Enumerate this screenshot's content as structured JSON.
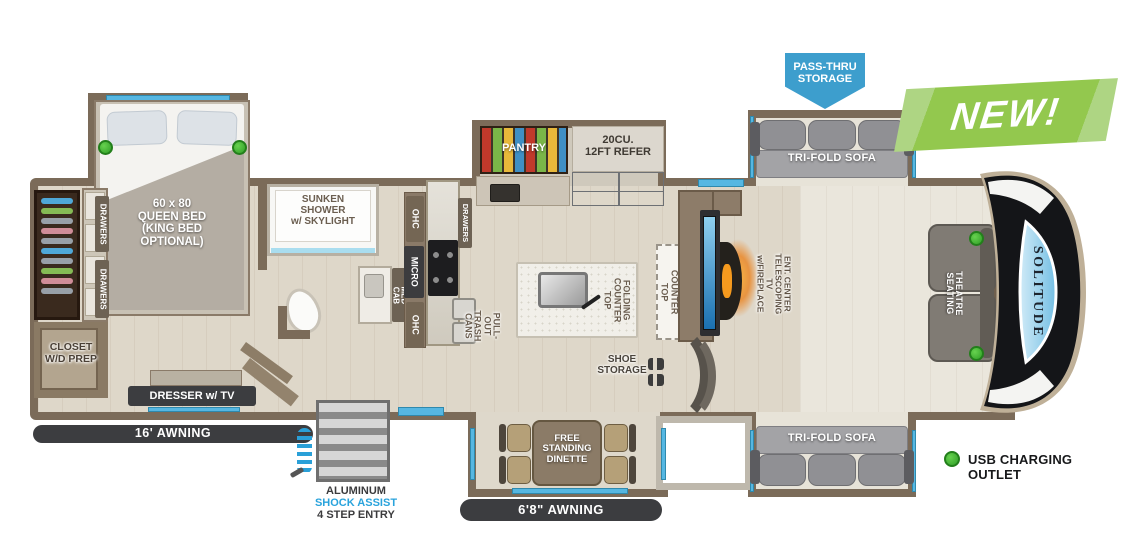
{
  "colors": {
    "accent_blue": "#56b7e2",
    "pass_thru_blue": "#3d9ecd",
    "new_green": "#93c84e",
    "usb_green": "#3cb535",
    "wall_brown": "#7b6b59"
  },
  "badges": {
    "new_label": "NEW!",
    "pass_thru_label": "PASS-THRU\nSTORAGE"
  },
  "legend": {
    "usb_label": "USB CHARGING OUTLET"
  },
  "front_cap": {
    "brand": "SOLITUDE"
  },
  "bedroom": {
    "bed_label": "60 x 80\nQUEEN BED\n(KING BED\nOPTIONAL)",
    "drawers_top_label": "DRAWERS",
    "drawers_bottom_label": "DRAWERS",
    "closet_label": "CLOSET\nW/D PREP",
    "dresser_label": "DRESSER w/ TV",
    "awning_label": "16' AWNING"
  },
  "bathroom": {
    "shower_label": "SUNKEN\nSHOWER\nw/ SKYLIGHT",
    "med_cab_label": "MED CAB"
  },
  "kitchen": {
    "ohc_top_label": "OHC",
    "micro_label": "MICRO",
    "ohc_bottom_label": "OHC",
    "drawers_label": "DRAWERS",
    "trash_label": "PULL-OUT\nTRASH CANS",
    "pantry_label": "PANTRY",
    "refer_label": "20CU.\n12FT REFER",
    "island_label": "FOLDING\nCOUNTER TOP",
    "flip_up_label": "FLIP UP\nCOUNTER TOP"
  },
  "living": {
    "ent_center_label": "ENT. CENTER\nTELESCOPING TV\nw/FIREPLACE",
    "sofa_top_label": "TRI-FOLD SOFA",
    "sofa_bottom_label": "TRI-FOLD SOFA",
    "theatre_label": "THEATRE SEATING"
  },
  "entry": {
    "shoe_label": "SHOE\nSTORAGE",
    "dinette_label": "FREE\nSTANDING\nDINETTE",
    "awning_label": "6'8\" AWNING",
    "steps_label_1": "ALUMINUM",
    "steps_label_2": "SHOCK ASSIST",
    "steps_label_3": "4 STEP ENTRY"
  }
}
